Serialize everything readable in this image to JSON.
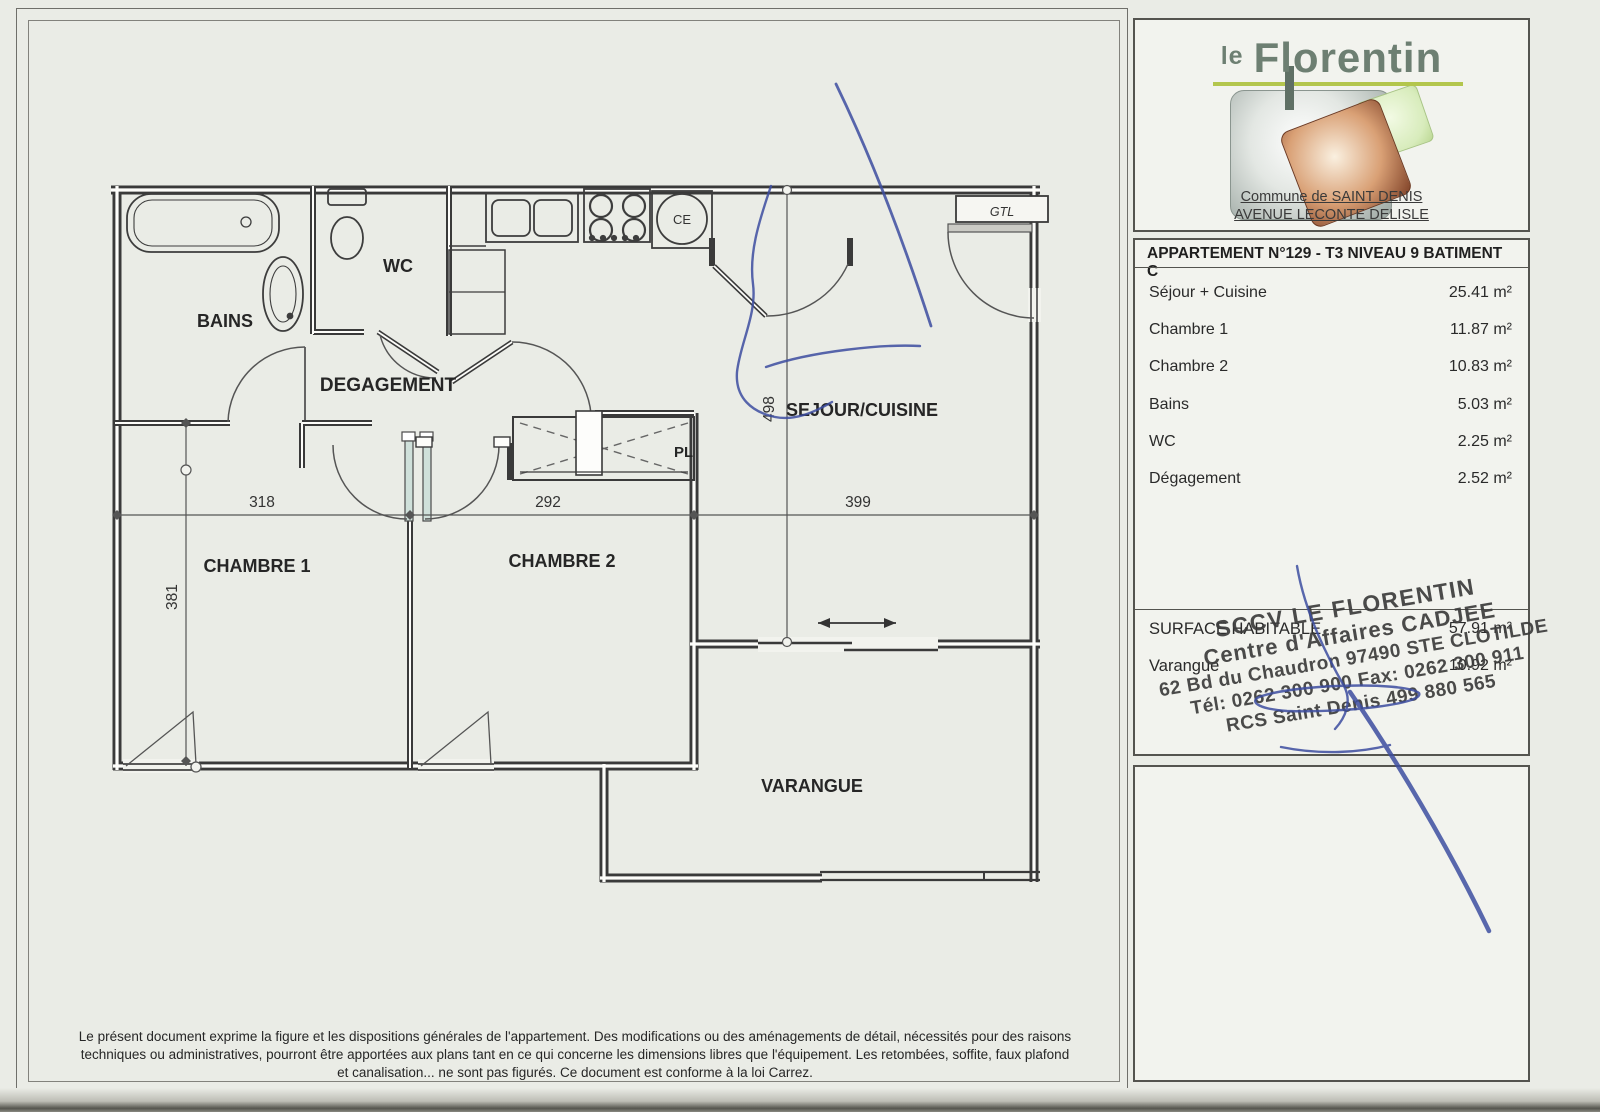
{
  "logo_panel": {
    "brand_small": "le",
    "brand_main": "Florentin",
    "address_line1": "Commune de SAINT DENIS",
    "address_line2": "AVENUE LECONTE DELISLE"
  },
  "info_panel": {
    "header": "APPARTEMENT N°129 - T3 NIVEAU 9 BATIMENT C",
    "rooms": [
      {
        "label": "Séjour + Cuisine",
        "area": "25.41 m²"
      },
      {
        "label": "Chambre 1",
        "area": "11.87 m²"
      },
      {
        "label": "Chambre 2",
        "area": "10.83 m²"
      },
      {
        "label": "Bains",
        "area": "5.03 m²"
      },
      {
        "label": "WC",
        "area": "2.25 m²"
      },
      {
        "label": "Dégagement",
        "area": "2.52 m²"
      }
    ],
    "summary": [
      {
        "label": "SURFACE HABITABLE",
        "area": "57.91 m²"
      },
      {
        "label": "Varangue",
        "area": "10.92 m²"
      }
    ]
  },
  "stamp": {
    "lines": [
      "SCCV LE FLORENTIN",
      "Centre d'Affaires CADJEE",
      "62 Bd du Chaudron 97490 STE CLOTILDE",
      "Tél: 0262 300 900  Fax: 0262 300 911",
      "RCS Saint Denis 499 880 565"
    ]
  },
  "plan": {
    "labels": {
      "bains": "BAINS",
      "wc": "WC",
      "degagement": "DEGAGEMENT",
      "sejour": "SEJOUR/CUISINE",
      "chambre1": "CHAMBRE 1",
      "chambre2": "CHAMBRE 2",
      "varangue": "VARANGUE",
      "pl": "PL",
      "gtl": "GTL",
      "ce": "CE"
    },
    "dims": {
      "chambre1_width": "318",
      "chambre2_width": "292",
      "sejour_width": "399",
      "chambre1_depth": "381",
      "sejour_depth": "498"
    }
  },
  "site_panel": {
    "north_label": "N"
  },
  "footer": {
    "line1": "Le présent document exprime la figure et les dispositions générales de l'appartement. Des modifications ou des aménagements de détail, nécessités pour des raisons",
    "line2": "techniques ou administratives, pourront être apportées aux plans tant en ce qui concerne les dimensions libres que l'équipement. Les retombées, soffite, faux plafond",
    "line3": "et canalisation... ne sont pas figurés. Ce document est conforme à la loi Carrez."
  },
  "colors": {
    "paper": "#eaece6",
    "wall_ink": "#3a3a3a",
    "pen_blue": "#3d4da0",
    "door_leaf_teal": "#cfe0da",
    "brand_text": "#6d7f72",
    "brand_underline": "#b3c64d",
    "logo_square_gray": "#9aa5a0",
    "logo_square_brown": "#7e4026",
    "logo_square_green": "#d8ecbc"
  }
}
